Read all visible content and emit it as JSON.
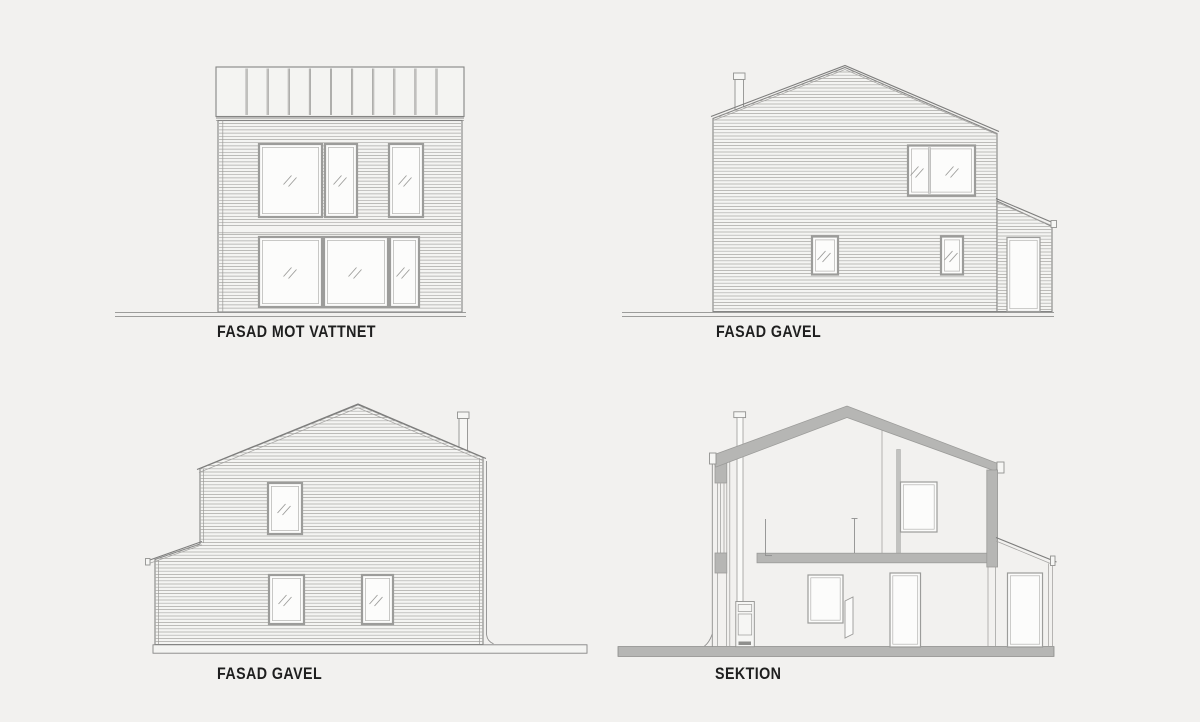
{
  "sheet": {
    "background": "#f2f1ef",
    "title": "House elevations and section drawing sheet"
  },
  "colors": {
    "line": "#8f8f8e",
    "siding_line": "#a9a8a5",
    "outline": "#858584",
    "poche_gray": "#b6b6b4",
    "wall_fill": "#f4f4f2",
    "glass_fill": "#fcfcfb",
    "label_text": "#1f1f1f"
  },
  "views": [
    {
      "id": "fasad-mot-vattnet",
      "label": "FASAD MOT VATTNET",
      "type": "elevation"
    },
    {
      "id": "fasad-gavel-east",
      "label": "FASAD GAVEL",
      "type": "elevation"
    },
    {
      "id": "fasad-gavel-west",
      "label": "FASAD GAVEL",
      "type": "elevation"
    },
    {
      "id": "sektion",
      "label": "SEKTION",
      "type": "section"
    }
  ]
}
